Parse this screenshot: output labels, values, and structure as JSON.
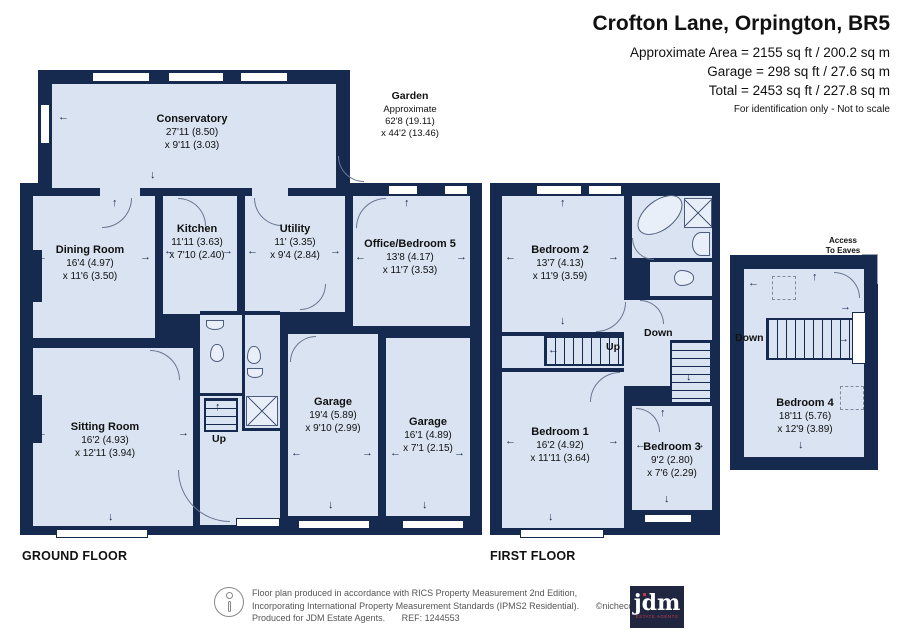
{
  "colors": {
    "wall": "#16294e",
    "room": "#d9e3f1"
  },
  "header": {
    "title": "Crofton Lane, Orpington, BR5",
    "area_line": "Approximate Area = 2155 sq ft / 200.2 sq m",
    "garage_line": "Garage = 298 sq ft / 27.6 sq m",
    "total_line": "Total = 2453 sq ft / 227.8 sq m",
    "disclaimer": "For identification only - Not to scale"
  },
  "floor_labels": {
    "ground": "GROUND FLOOR",
    "first": "FIRST FLOOR"
  },
  "nav": {
    "up": "Up",
    "down": "Down",
    "access_line1": "Access",
    "access_line2": "To Eaves"
  },
  "rooms": {
    "conservatory": {
      "name": "Conservatory",
      "dim1": "27'11 (8.50)",
      "dim2": "x 9'11 (3.03)"
    },
    "garden": {
      "name": "Garden",
      "note": "Approximate",
      "dim1": "62'8 (19.11)",
      "dim2": "x 44'2 (13.46)"
    },
    "dining": {
      "name": "Dining Room",
      "dim1": "16'4 (4.97)",
      "dim2": "x 11'6 (3.50)"
    },
    "kitchen": {
      "name": "Kitchen",
      "dim1": "11'11 (3.63)",
      "dim2": "x 7'10 (2.40)"
    },
    "utility": {
      "name": "Utility",
      "dim1": "11' (3.35)",
      "dim2": "x 9'4 (2.84)"
    },
    "office": {
      "name": "Office/Bedroom 5",
      "dim1": "13'8 (4.17)",
      "dim2": "x 11'7 (3.53)"
    },
    "sitting": {
      "name": "Sitting Room",
      "dim1": "16'2 (4.93)",
      "dim2": "x 12'11 (3.94)"
    },
    "garage1": {
      "name": "Garage",
      "dim1": "19'4 (5.89)",
      "dim2": "x 9'10 (2.99)"
    },
    "garage2": {
      "name": "Garage",
      "dim1": "16'1 (4.89)",
      "dim2": "x 7'1 (2.15)"
    },
    "bedroom1": {
      "name": "Bedroom 1",
      "dim1": "16'2 (4.92)",
      "dim2": "x 11'11 (3.64)"
    },
    "bedroom2": {
      "name": "Bedroom 2",
      "dim1": "13'7 (4.13)",
      "dim2": "x 11'9 (3.59)"
    },
    "bedroom3": {
      "name": "Bedroom 3",
      "dim1": "9'2 (2.80)",
      "dim2": "x 7'6 (2.29)"
    },
    "bedroom4": {
      "name": "Bedroom 4",
      "dim1": "18'11 (5.76)",
      "dim2": "x 12'9 (3.89)"
    }
  },
  "footer": {
    "line1": "Floor plan produced in accordance with RICS Property Measurement 2nd Edition,",
    "line2": "Incorporating International Property Measurement Standards (IPMS2 Residential).",
    "copyright": "©nichecom 2025.",
    "line3a": "Produced for JDM Estate Agents.",
    "line3b": "REF: 1244553",
    "logo_text": "jdm",
    "logo_sub": "ESTATE AGENTS"
  }
}
